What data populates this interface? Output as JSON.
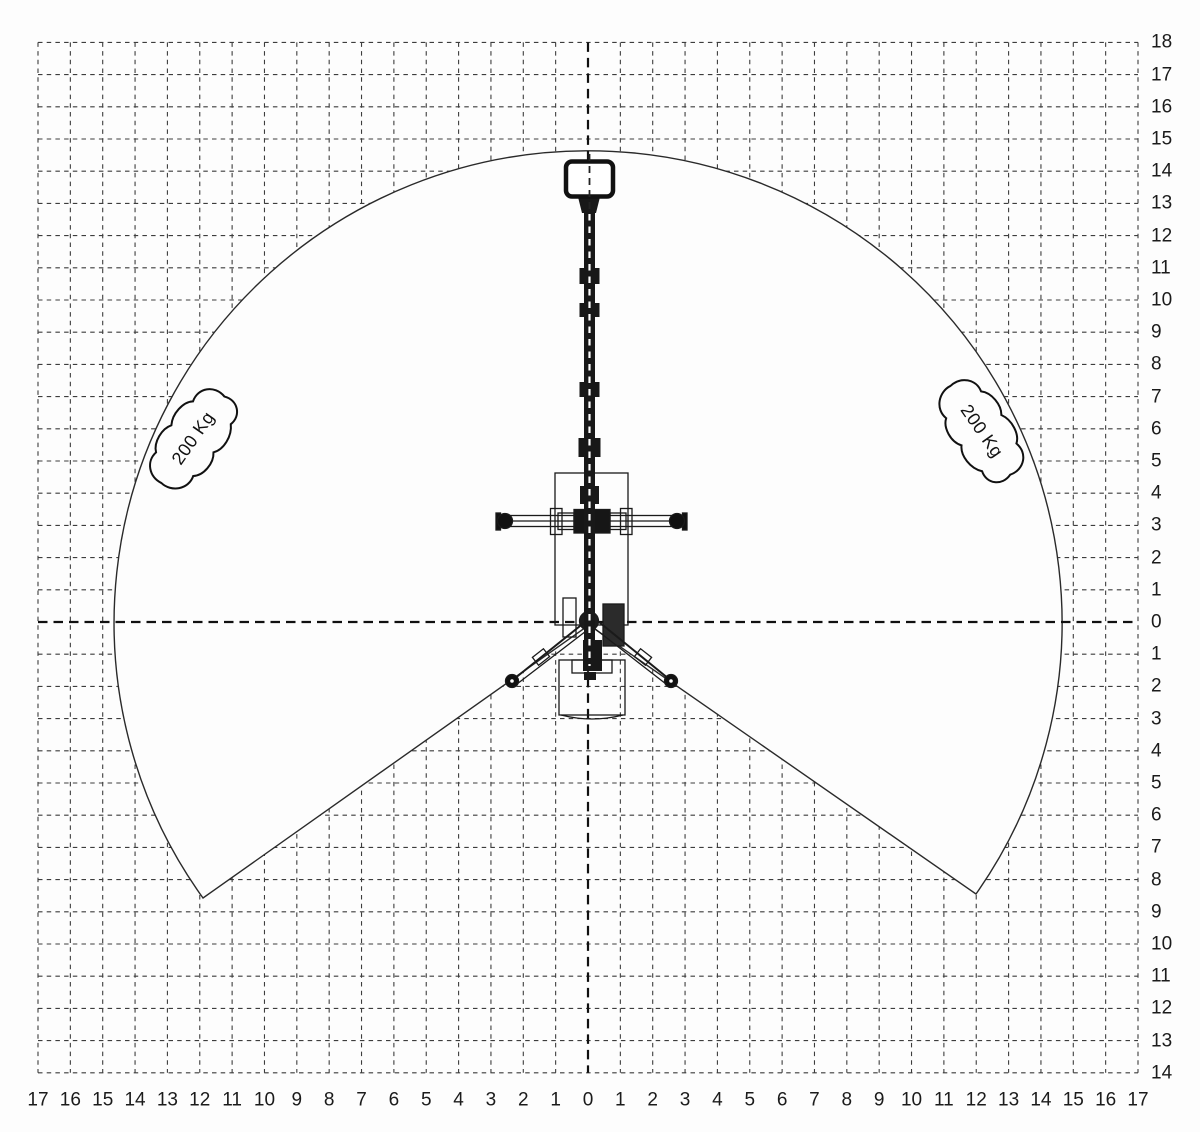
{
  "chart_data": {
    "type": "working-envelope-diagram",
    "x_axis": {
      "ticks": [
        "17",
        "16",
        "15",
        "14",
        "13",
        "12",
        "11",
        "10",
        "9",
        "8",
        "7",
        "6",
        "5",
        "4",
        "3",
        "2",
        "1",
        "0",
        "1",
        "2",
        "3",
        "4",
        "5",
        "6",
        "7",
        "8",
        "9",
        "10",
        "11",
        "12",
        "13",
        "14",
        "15",
        "16",
        "17"
      ],
      "min": -17,
      "max": 17
    },
    "y_axis": {
      "ticks": [
        "18",
        "17",
        "16",
        "15",
        "14",
        "13",
        "12",
        "11",
        "10",
        "9",
        "8",
        "7",
        "6",
        "5",
        "4",
        "3",
        "2",
        "1",
        "0",
        "1",
        "2",
        "3",
        "4",
        "5",
        "6",
        "7",
        "8",
        "9",
        "10",
        "11",
        "12",
        "13",
        "14"
      ],
      "min": -14,
      "max": 18
    },
    "envelope": {
      "shape": "circle-with-bottom-cutout",
      "radius_units": 14.7,
      "center": [
        0,
        0
      ],
      "cutout_apex": [
        0,
        0
      ],
      "cutout_left_vertex": [
        -11.9,
        -8.6
      ],
      "cutout_right_vertex": [
        12.0,
        -8.5
      ]
    },
    "load_labels": [
      {
        "text": "200 Kg",
        "side": "left",
        "position_units": [
          -12.2,
          5.7
        ]
      },
      {
        "text": "200 Kg",
        "side": "right",
        "position_units": [
          12.2,
          5.9
        ]
      }
    ],
    "grid": {
      "visible_outside_envelope": true,
      "style": "dashed",
      "cell_units": 1
    },
    "colors": {
      "line": "#1a1a1a",
      "grid": "#3d3d3d",
      "background": "#fdfdfd"
    }
  }
}
